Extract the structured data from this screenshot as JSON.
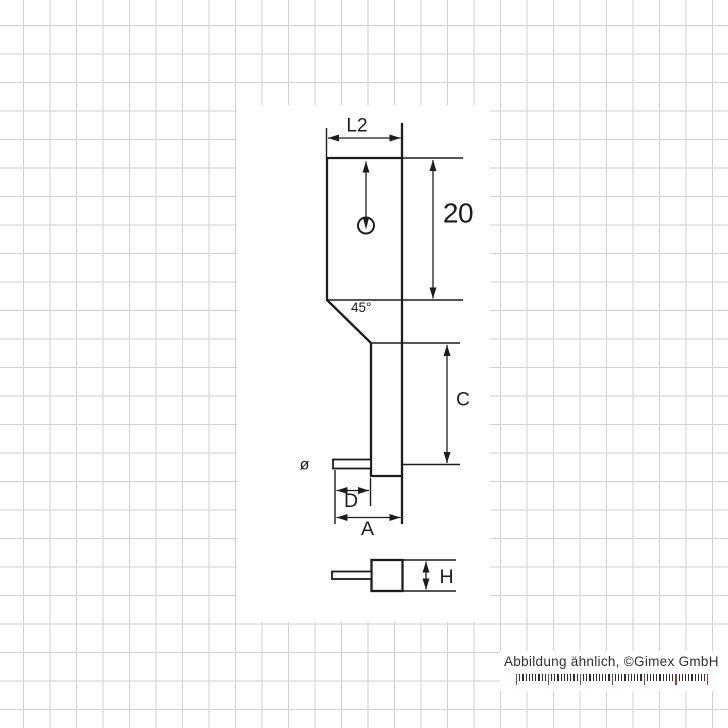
{
  "drawing": {
    "labels": {
      "l2": "L2",
      "body_height": "20",
      "chamfer_angle": "45°",
      "shaft_length_c": "C",
      "diameter_symbol": "ø",
      "pin_length_d": "D",
      "tip_length_a": "A",
      "tip_height_h": "H"
    },
    "line_color": "#1c1c1c"
  },
  "footer": {
    "caption": "Abbildung ähnlich, ©Gimex GmbH",
    "text_color": "#2f2f2f"
  },
  "ruler": {
    "tick_count": 61,
    "major_every": 10,
    "minor_color": "#2e2e2e",
    "major_color": "#b03438"
  },
  "grid": {
    "line_color": "#d2d2d5",
    "background": "#ffffff"
  }
}
